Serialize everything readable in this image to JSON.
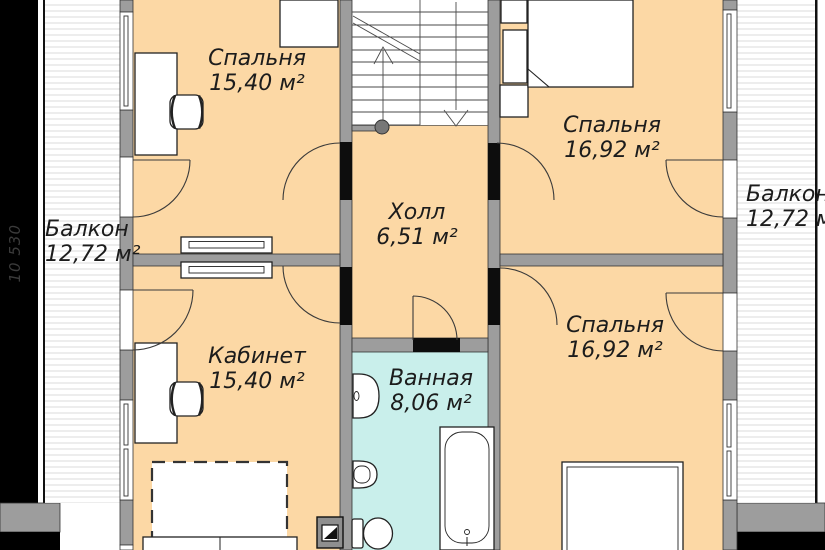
{
  "side_dimension": "10 530",
  "rooms": {
    "bedroom_top_left": {
      "name": "Спальня",
      "area": "15,40 м²"
    },
    "bedroom_top_right": {
      "name": "Спальня",
      "area": "16,92 м²"
    },
    "hall": {
      "name": "Холл",
      "area": "6,51 м²"
    },
    "balcony_left": {
      "name": "Балкон",
      "area": "12,72 м²"
    },
    "balcony_right": {
      "name": "Балкон",
      "area": "12,72 м²"
    },
    "office": {
      "name": "Кабинет",
      "area": "15,40 м²"
    },
    "bathroom": {
      "name": "Ванная",
      "area": "8,06 м²"
    },
    "bedroom_bottom_right": {
      "name": "Спальня",
      "area": "16,92 м²"
    }
  },
  "colors": {
    "floor": "#fcd8a5",
    "bathroom_floor": "#c9efeb",
    "wall": "#9d9d9d",
    "door": "#0d0d0d",
    "text": "#1c1c1c",
    "balcony_stripe": "#ededed",
    "frame_black": "#000000"
  }
}
